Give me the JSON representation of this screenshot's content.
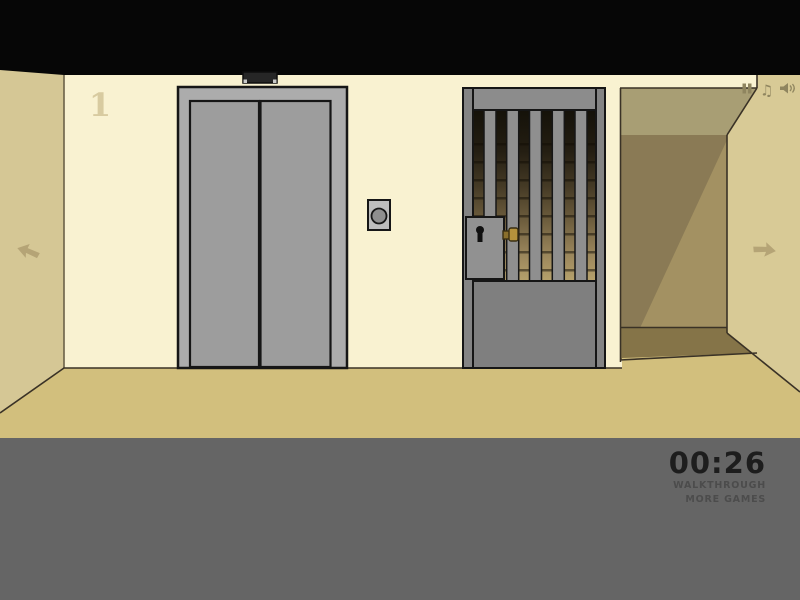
{
  "hud": {
    "floor_number": "1",
    "timer": "00:26",
    "walkthrough": "WALKTHROUGH",
    "more_games": "MORE GAMES"
  },
  "icons": {
    "music_glyph": "♫",
    "names": [
      "pause-icon",
      "music-note-icon",
      "speaker-icon",
      "nav-arrow-left",
      "nav-arrow-right"
    ]
  },
  "colors": {
    "ceiling": "#060606",
    "wall": "#f9f2d1",
    "side_wall": "#d5c795",
    "side_wall_edge": "#6b6148",
    "floor": "#d2bf7d",
    "line": "#3a3226",
    "outline": "#161616",
    "number": "#d8cba0",
    "arrow": "#b5a476",
    "bottom_bar": "#656565",
    "timer_text": "#1d1d1d",
    "link_text": "#4c4c4c",
    "elevator_frame": "#acacac",
    "elevator_door": "#9d9d9d",
    "indicator": "#262626",
    "indicator_dot": "#c9c9c9",
    "call_plate": "#bdbdbd",
    "call_button": "#8f8f8f",
    "gate_lintel": "#8c8c8c",
    "gate_post": "#848484",
    "gate_panel": "#7f7f7f",
    "gate_bar": "#8f8f8f",
    "lock_body": "#919191",
    "keyhole": "#101010",
    "latch_gold": "#b5923c",
    "latch_dark": "#8a6f2b",
    "latch_outline": "#3a2f12",
    "stair_top": "#141109",
    "stair_mid": "#6e5e3e",
    "stair_bottom": "#b7a26c",
    "corridor_ceiling": "#a89e74",
    "corridor_dark": "#8a7a55",
    "corridor_light": "#a39162",
    "corridor_floor": "#857448",
    "right_wall": "#d8ca96",
    "icon": "#8f855f"
  }
}
